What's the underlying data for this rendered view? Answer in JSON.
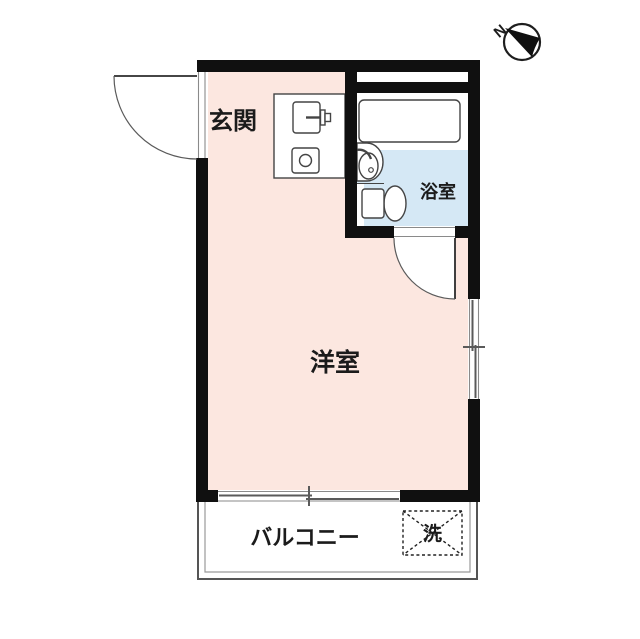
{
  "plan": {
    "rooms": {
      "entrance": {
        "label": "玄関"
      },
      "western_room": {
        "label": "洋室"
      },
      "bathroom": {
        "label": "浴室"
      },
      "balcony": {
        "label": "バルコニー"
      },
      "washer": {
        "label": "洗"
      }
    },
    "compass": {
      "label": "N"
    },
    "colors": {
      "room_fill": "#fce7e0",
      "bathroom_fill": "#d5e8f5",
      "wall": "#101010",
      "white": "#ffffff"
    }
  }
}
